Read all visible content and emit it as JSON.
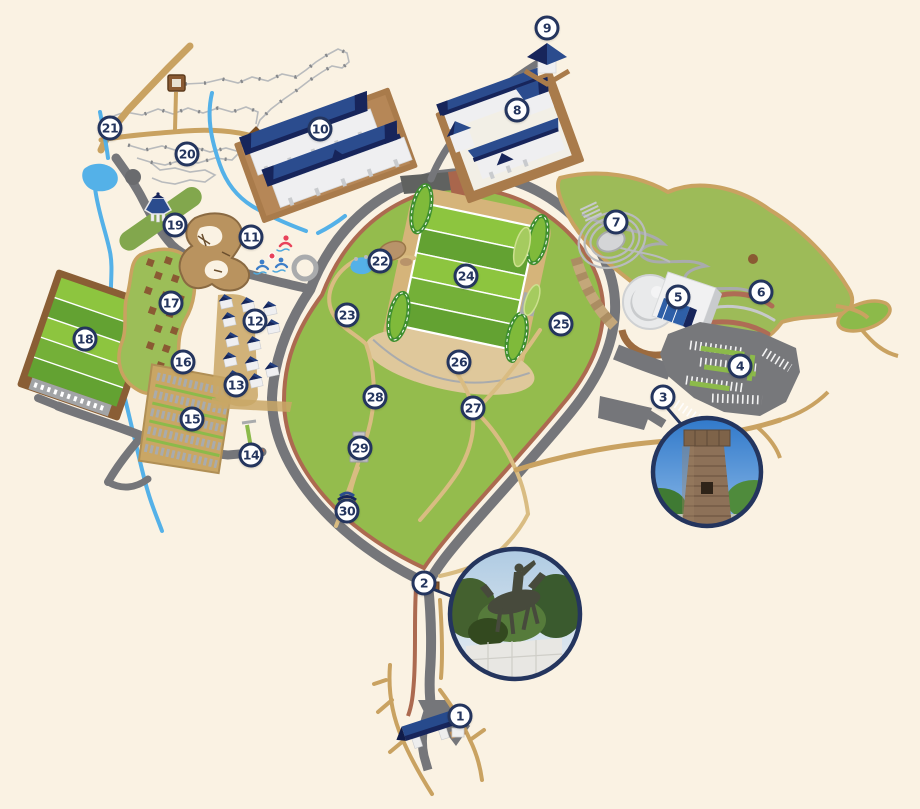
{
  "map": {
    "name": "illustrated-heritage-park-map",
    "background_color": "#FAF2E3",
    "marker_style": {
      "fill": "#FFFFFF",
      "border": "#24355E",
      "text_color": "#24355E"
    },
    "markers": [
      {
        "label": "1",
        "x": 460,
        "y": 716
      },
      {
        "label": "2",
        "x": 424,
        "y": 583
      },
      {
        "label": "3",
        "x": 663,
        "y": 397
      },
      {
        "label": "4",
        "x": 740,
        "y": 366
      },
      {
        "label": "5",
        "x": 678,
        "y": 297
      },
      {
        "label": "6",
        "x": 761,
        "y": 292
      },
      {
        "label": "7",
        "x": 616,
        "y": 222
      },
      {
        "label": "8",
        "x": 517,
        "y": 110
      },
      {
        "label": "9",
        "x": 547,
        "y": 28
      },
      {
        "label": "10",
        "x": 320,
        "y": 129
      },
      {
        "label": "11",
        "x": 251,
        "y": 237
      },
      {
        "label": "12",
        "x": 255,
        "y": 321
      },
      {
        "label": "13",
        "x": 236,
        "y": 385
      },
      {
        "label": "14",
        "x": 251,
        "y": 455
      },
      {
        "label": "15",
        "x": 192,
        "y": 419
      },
      {
        "label": "16",
        "x": 183,
        "y": 362
      },
      {
        "label": "17",
        "x": 171,
        "y": 303
      },
      {
        "label": "18",
        "x": 85,
        "y": 339
      },
      {
        "label": "19",
        "x": 175,
        "y": 225
      },
      {
        "label": "20",
        "x": 187,
        "y": 154
      },
      {
        "label": "21",
        "x": 110,
        "y": 128
      },
      {
        "label": "22",
        "x": 380,
        "y": 261
      },
      {
        "label": "23",
        "x": 347,
        "y": 315
      },
      {
        "label": "24",
        "x": 466,
        "y": 276
      },
      {
        "label": "25",
        "x": 561,
        "y": 324
      },
      {
        "label": "26",
        "x": 459,
        "y": 362
      },
      {
        "label": "27",
        "x": 473,
        "y": 408
      },
      {
        "label": "28",
        "x": 375,
        "y": 397
      },
      {
        "label": "29",
        "x": 360,
        "y": 448
      },
      {
        "label": "30",
        "x": 347,
        "y": 511
      }
    ],
    "photos": [
      {
        "name": "stone-observatory-photo",
        "cx": 707,
        "cy": 472,
        "r": 55,
        "linked_marker": "3"
      },
      {
        "name": "equestrian-statue-photo",
        "cx": 515,
        "cy": 614,
        "r": 66,
        "linked_marker": "2"
      }
    ],
    "icons": [
      "trail-hut-icon",
      "trail-marker-diamond-icon",
      "pavilion-gazebo-icon",
      "fountain-icon",
      "swimmer-icons",
      "stone-monument-icon",
      "small-pavilion-icon",
      "gate-building-icon",
      "hanok-building-icons",
      "village-house-icons",
      "amphitheater-icon",
      "round-museum-icon",
      "parking-lot-icon",
      "burial-mound-icon"
    ],
    "palette": {
      "background": "#FAF2E3",
      "road_gray": "#75767A",
      "track_red_brown": "#AC6A50",
      "path_tan": "#C9A261",
      "path_light_tan": "#D9BC82",
      "park_green": "#94BC4D",
      "garden_green": "#9DBB58",
      "field_green_light": "#8DC53F",
      "field_green_dark": "#63A232",
      "water_blue": "#54B1E8",
      "roof_navy": "#2B4C8E",
      "roof_navy_dark": "#17255B",
      "platform_brown": "#A97B4B",
      "marker_navy": "#24355E"
    }
  }
}
